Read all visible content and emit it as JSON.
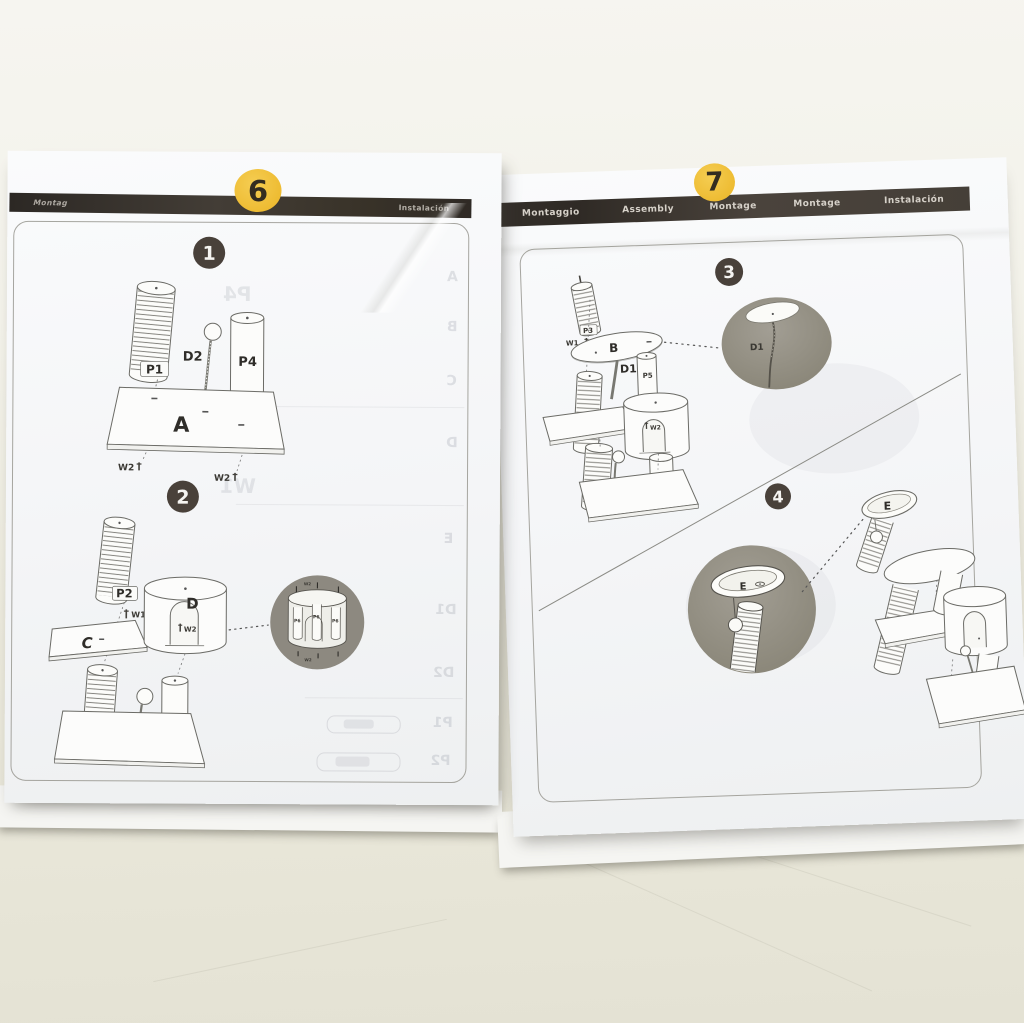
{
  "left_page": {
    "page_number": "6",
    "header": {
      "left_label": "Montag",
      "right_label": "Instalación"
    },
    "step1": {
      "number": "1",
      "post_left": "P1",
      "toy": "D2",
      "post_right": "P4",
      "base_board": "A",
      "screw_left": "W2",
      "screw_right": "W2"
    },
    "step2": {
      "number": "2",
      "post": "P2",
      "screw_top": "W1",
      "shelf": "C",
      "condo": "D",
      "screw_inside": "W2",
      "detail": {
        "inner_post": "P6",
        "inner_screw": "W2"
      }
    },
    "ghost_labels": [
      "A",
      "B",
      "C",
      "D",
      "E",
      "D1",
      "D2",
      "P1",
      "P2",
      "W1",
      "P4"
    ]
  },
  "right_page": {
    "page_number": "7",
    "header": {
      "labels": [
        "Montaggio",
        "Assembly",
        "Montage",
        "Montage",
        "Instalación"
      ]
    },
    "step3": {
      "number": "3",
      "post_top": "P3",
      "screw_top": "W1",
      "platform": "B",
      "spring_toy": "D1",
      "post_small": "P5",
      "screw_inside": "W2",
      "detail_label": "D1"
    },
    "step4": {
      "number": "4",
      "perch_main": "E",
      "perch_detail": "E"
    }
  }
}
